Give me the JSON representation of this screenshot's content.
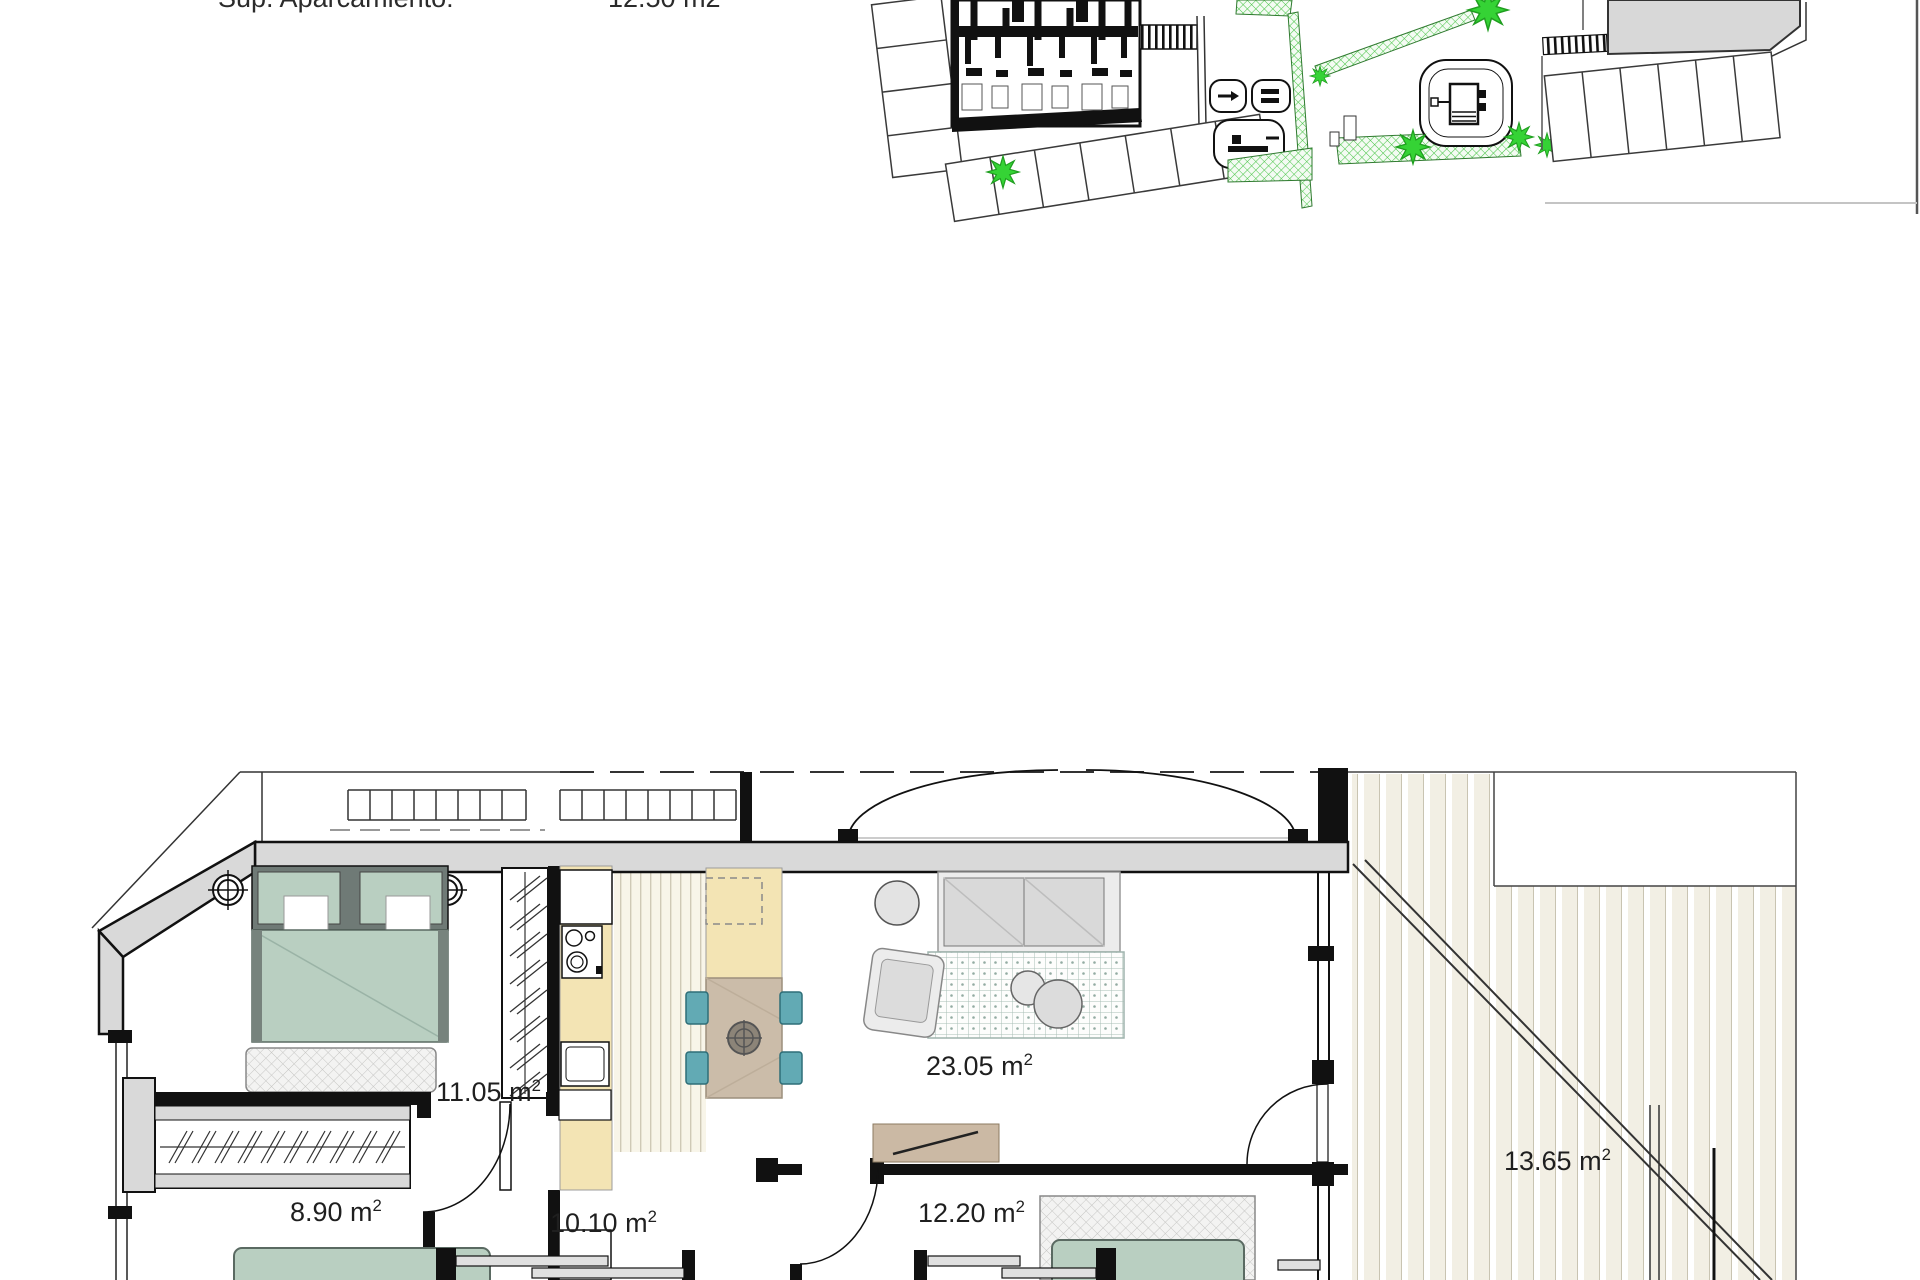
{
  "header": {
    "label": "Sup. Aparcamiento:",
    "value": "12.50 m2"
  },
  "floor_plan": {
    "rooms": [
      {
        "id": "bedroom-1",
        "area_value": "11.05 m",
        "area_sup": "2"
      },
      {
        "id": "living-dining-kitchen",
        "area_value": "23.05 m",
        "area_sup": "2"
      },
      {
        "id": "bedroom-2",
        "area_value": "8.90 m",
        "area_sup": "2"
      },
      {
        "id": "bedroom-3",
        "area_value": "10.10 m",
        "area_sup": "2"
      },
      {
        "id": "bedroom-4",
        "area_value": "12.20 m",
        "area_sup": "2"
      },
      {
        "id": "terrace",
        "area_value": "13.65 m",
        "area_sup": "2"
      }
    ]
  },
  "site_plan": {
    "features": [
      "building-footprint",
      "parking-spaces",
      "stairs",
      "playground",
      "trees",
      "green-paths",
      "neighbor-building"
    ]
  },
  "colors": {
    "wall_fill": "#d9d9d9",
    "bed_green": "#b9cfc1",
    "counter_yellow": "#f3e4b4",
    "table_tan": "#cbbca9",
    "chair_teal": "#62aab4",
    "tree_green": "#35d335",
    "deck_cream": "#f2efe4"
  }
}
